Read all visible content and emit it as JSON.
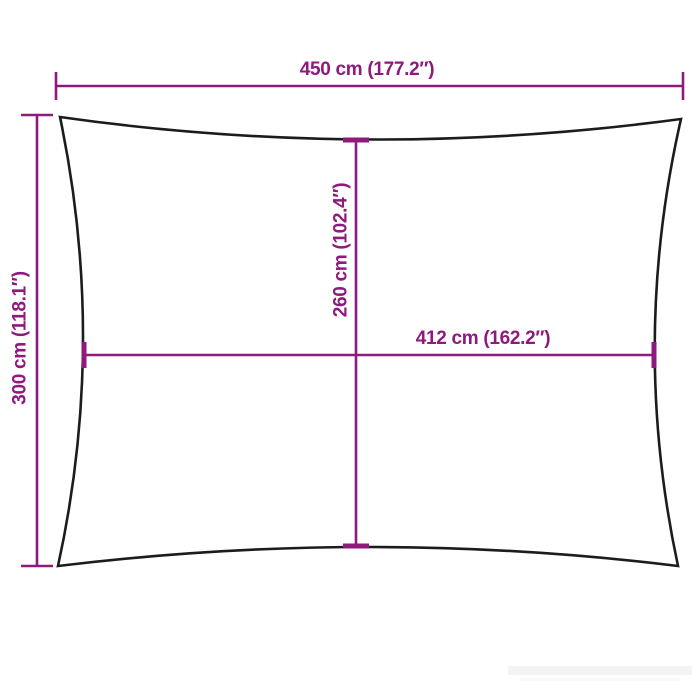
{
  "diagram": {
    "type": "product-dimension-diagram",
    "subject": "rectangular shade sail outline with concave edges",
    "colors": {
      "accent": "#8e1a7d",
      "outline": "#1c1c1c",
      "background": "#ffffff",
      "watermark": "#f3f3f3"
    },
    "dimensions": {
      "top_width": {
        "label": "450 cm (177.2″)",
        "value_cm": 450,
        "value_in": 177.2
      },
      "left_height": {
        "label": "300 cm (118.1″)",
        "value_cm": 300,
        "value_in": 118.1
      },
      "inner_vertical": {
        "label": "260 cm (102.4″)",
        "value_cm": 260,
        "value_in": 102.4
      },
      "inner_horizontal": {
        "label": "412 cm (162.2″)",
        "value_cm": 412,
        "value_in": 162.2
      }
    }
  }
}
